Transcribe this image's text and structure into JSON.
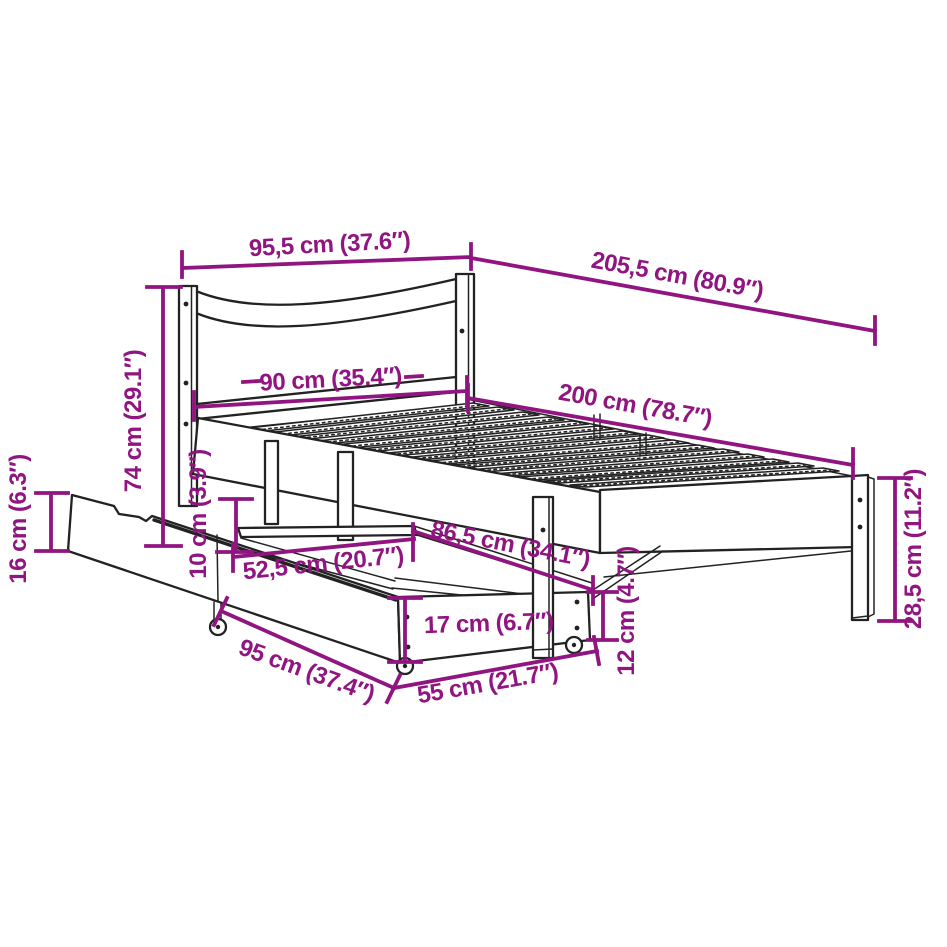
{
  "diagram": {
    "type": "product-dimension-diagram",
    "subject": "bed-frame-with-drawers",
    "colors": {
      "dimension": "#911580",
      "line": "#222222",
      "background": "#ffffff"
    },
    "dimensions": {
      "top_width": {
        "label": "95,5 cm (37.6″)",
        "cm": 95.5,
        "in": 37.6
      },
      "overall_length": {
        "label": "205,5 cm (80.9″)",
        "cm": 205.5,
        "in": 80.9
      },
      "bed_width": {
        "label": "90 cm (35.4″)",
        "cm": 90,
        "in": 35.4
      },
      "bed_length": {
        "label": "200 cm (78.7″)",
        "cm": 200,
        "in": 78.7
      },
      "headboard_height": {
        "label": "74 cm (29.1″)",
        "cm": 74,
        "in": 29.1
      },
      "drawer_left_height": {
        "label": "16 cm (6.3″)",
        "cm": 16,
        "in": 6.3
      },
      "clearance_height": {
        "label": "10 cm (3.9″)",
        "cm": 10,
        "in": 3.9
      },
      "drawer_inner_length": {
        "label": "52,5 cm (20.7″)",
        "cm": 52.5,
        "in": 20.7
      },
      "drawer_top_length": {
        "label": "86,5 cm (34.1″)",
        "cm": 86.5,
        "in": 34.1
      },
      "drawer_front_height": {
        "label": "17 cm (6.7″)",
        "cm": 17,
        "in": 6.7
      },
      "drawer_length": {
        "label": "95 cm (37.4″)",
        "cm": 95,
        "in": 37.4
      },
      "drawer_depth": {
        "label": "55 cm (21.7″)",
        "cm": 55,
        "in": 21.7
      },
      "drawer_side_height": {
        "label": "12 cm (4.7″)",
        "cm": 12,
        "in": 4.7
      },
      "leg_height": {
        "label": "28,5 cm (11.2″)",
        "cm": 28.5,
        "in": 11.2
      }
    }
  }
}
